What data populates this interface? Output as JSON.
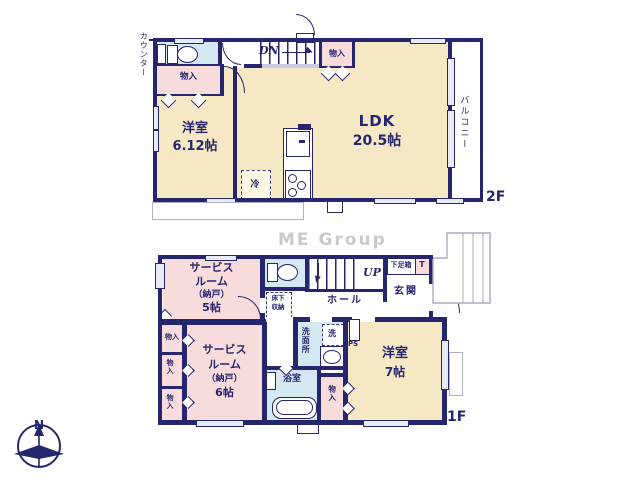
{
  "watermark": "ME Group",
  "colors": {
    "wall": "#26266e",
    "cream": "#f6e8c4",
    "pink": "#f8dcdb",
    "blue": "#d4e8f2",
    "gray_outline": "#aeb3c2",
    "watermark": "#c9c9c9"
  },
  "floor2": {
    "label": "2F",
    "counter": "カウンター",
    "stairs": "DN",
    "closet_top": "物入",
    "closet_left": "物入",
    "room_west_name": "洋室",
    "room_west_size": "6.12帖",
    "ldk_name": "LDK",
    "ldk_size": "20.5帖",
    "fridge": "冷",
    "balcony": "バルコニー"
  },
  "floor1": {
    "label": "1F",
    "service5": {
      "l1": "サービス",
      "l2": "ルーム",
      "l3": "（納戸）",
      "l4": "5帖"
    },
    "service6": {
      "l1": "サービス",
      "l2": "ルーム",
      "l3": "（納戸）",
      "l4": "6帖"
    },
    "stairs": "UP",
    "hall": "ホール",
    "underfloor": {
      "l1": "床下",
      "l2": "収納"
    },
    "shoebox": "下足箱",
    "shoebox_t": "T",
    "entrance": "玄関",
    "washroom": "洗面所",
    "washer": "洗",
    "ps": "PS",
    "room_east_name": "洋室",
    "room_east_size": "7帖",
    "bath": "浴室",
    "closet_mid": "物入",
    "closet_a": "物入",
    "closet_b": "物入",
    "closet_c": "物入"
  },
  "compass": {
    "north": "N"
  }
}
